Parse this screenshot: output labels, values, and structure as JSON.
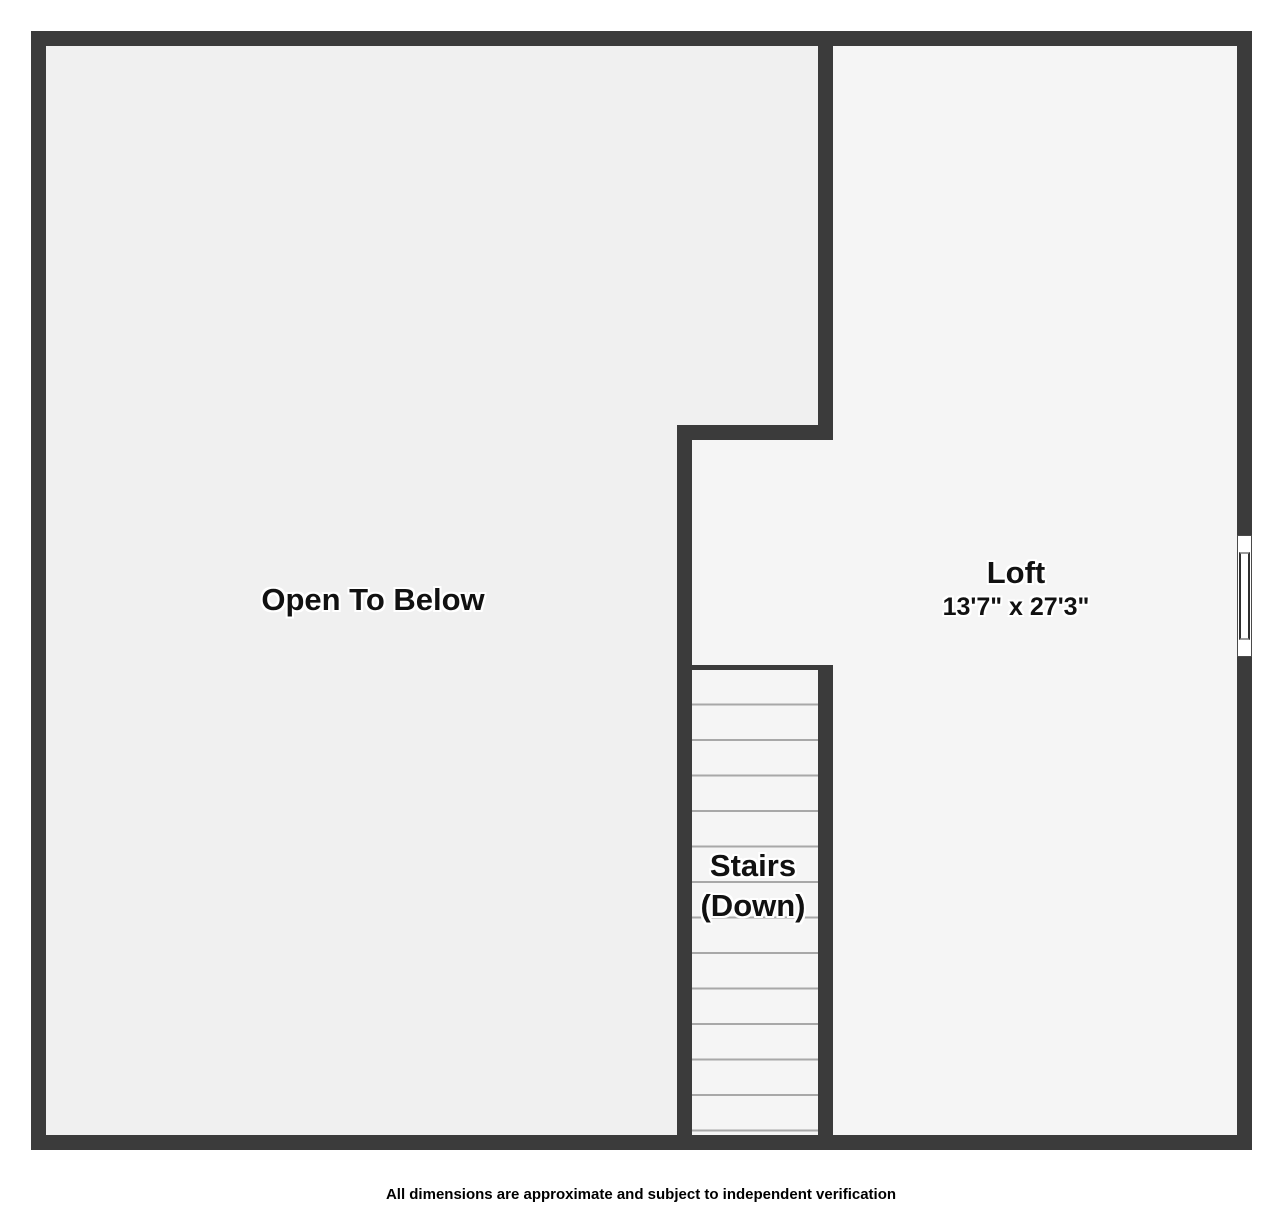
{
  "rooms": {
    "open_to_below": {
      "label": "Open To Below"
    },
    "loft": {
      "label": "Loft",
      "dimensions": "13'7\" x 27'3\""
    },
    "stairs": {
      "line1": "Stairs",
      "line2": "(Down)"
    }
  },
  "features": {
    "window": {
      "name": "window",
      "wall": "right"
    }
  },
  "footer": {
    "disclaimer": "All dimensions are approximate and subject to independent verification"
  },
  "colors": {
    "wall": "#3b3b3b",
    "open_to_below_fill": "#f0f0f0",
    "loft_fill": "#f5f5f5",
    "tread_line": "#a8a8a8",
    "text": "#111111",
    "halo": "#ffffff"
  }
}
